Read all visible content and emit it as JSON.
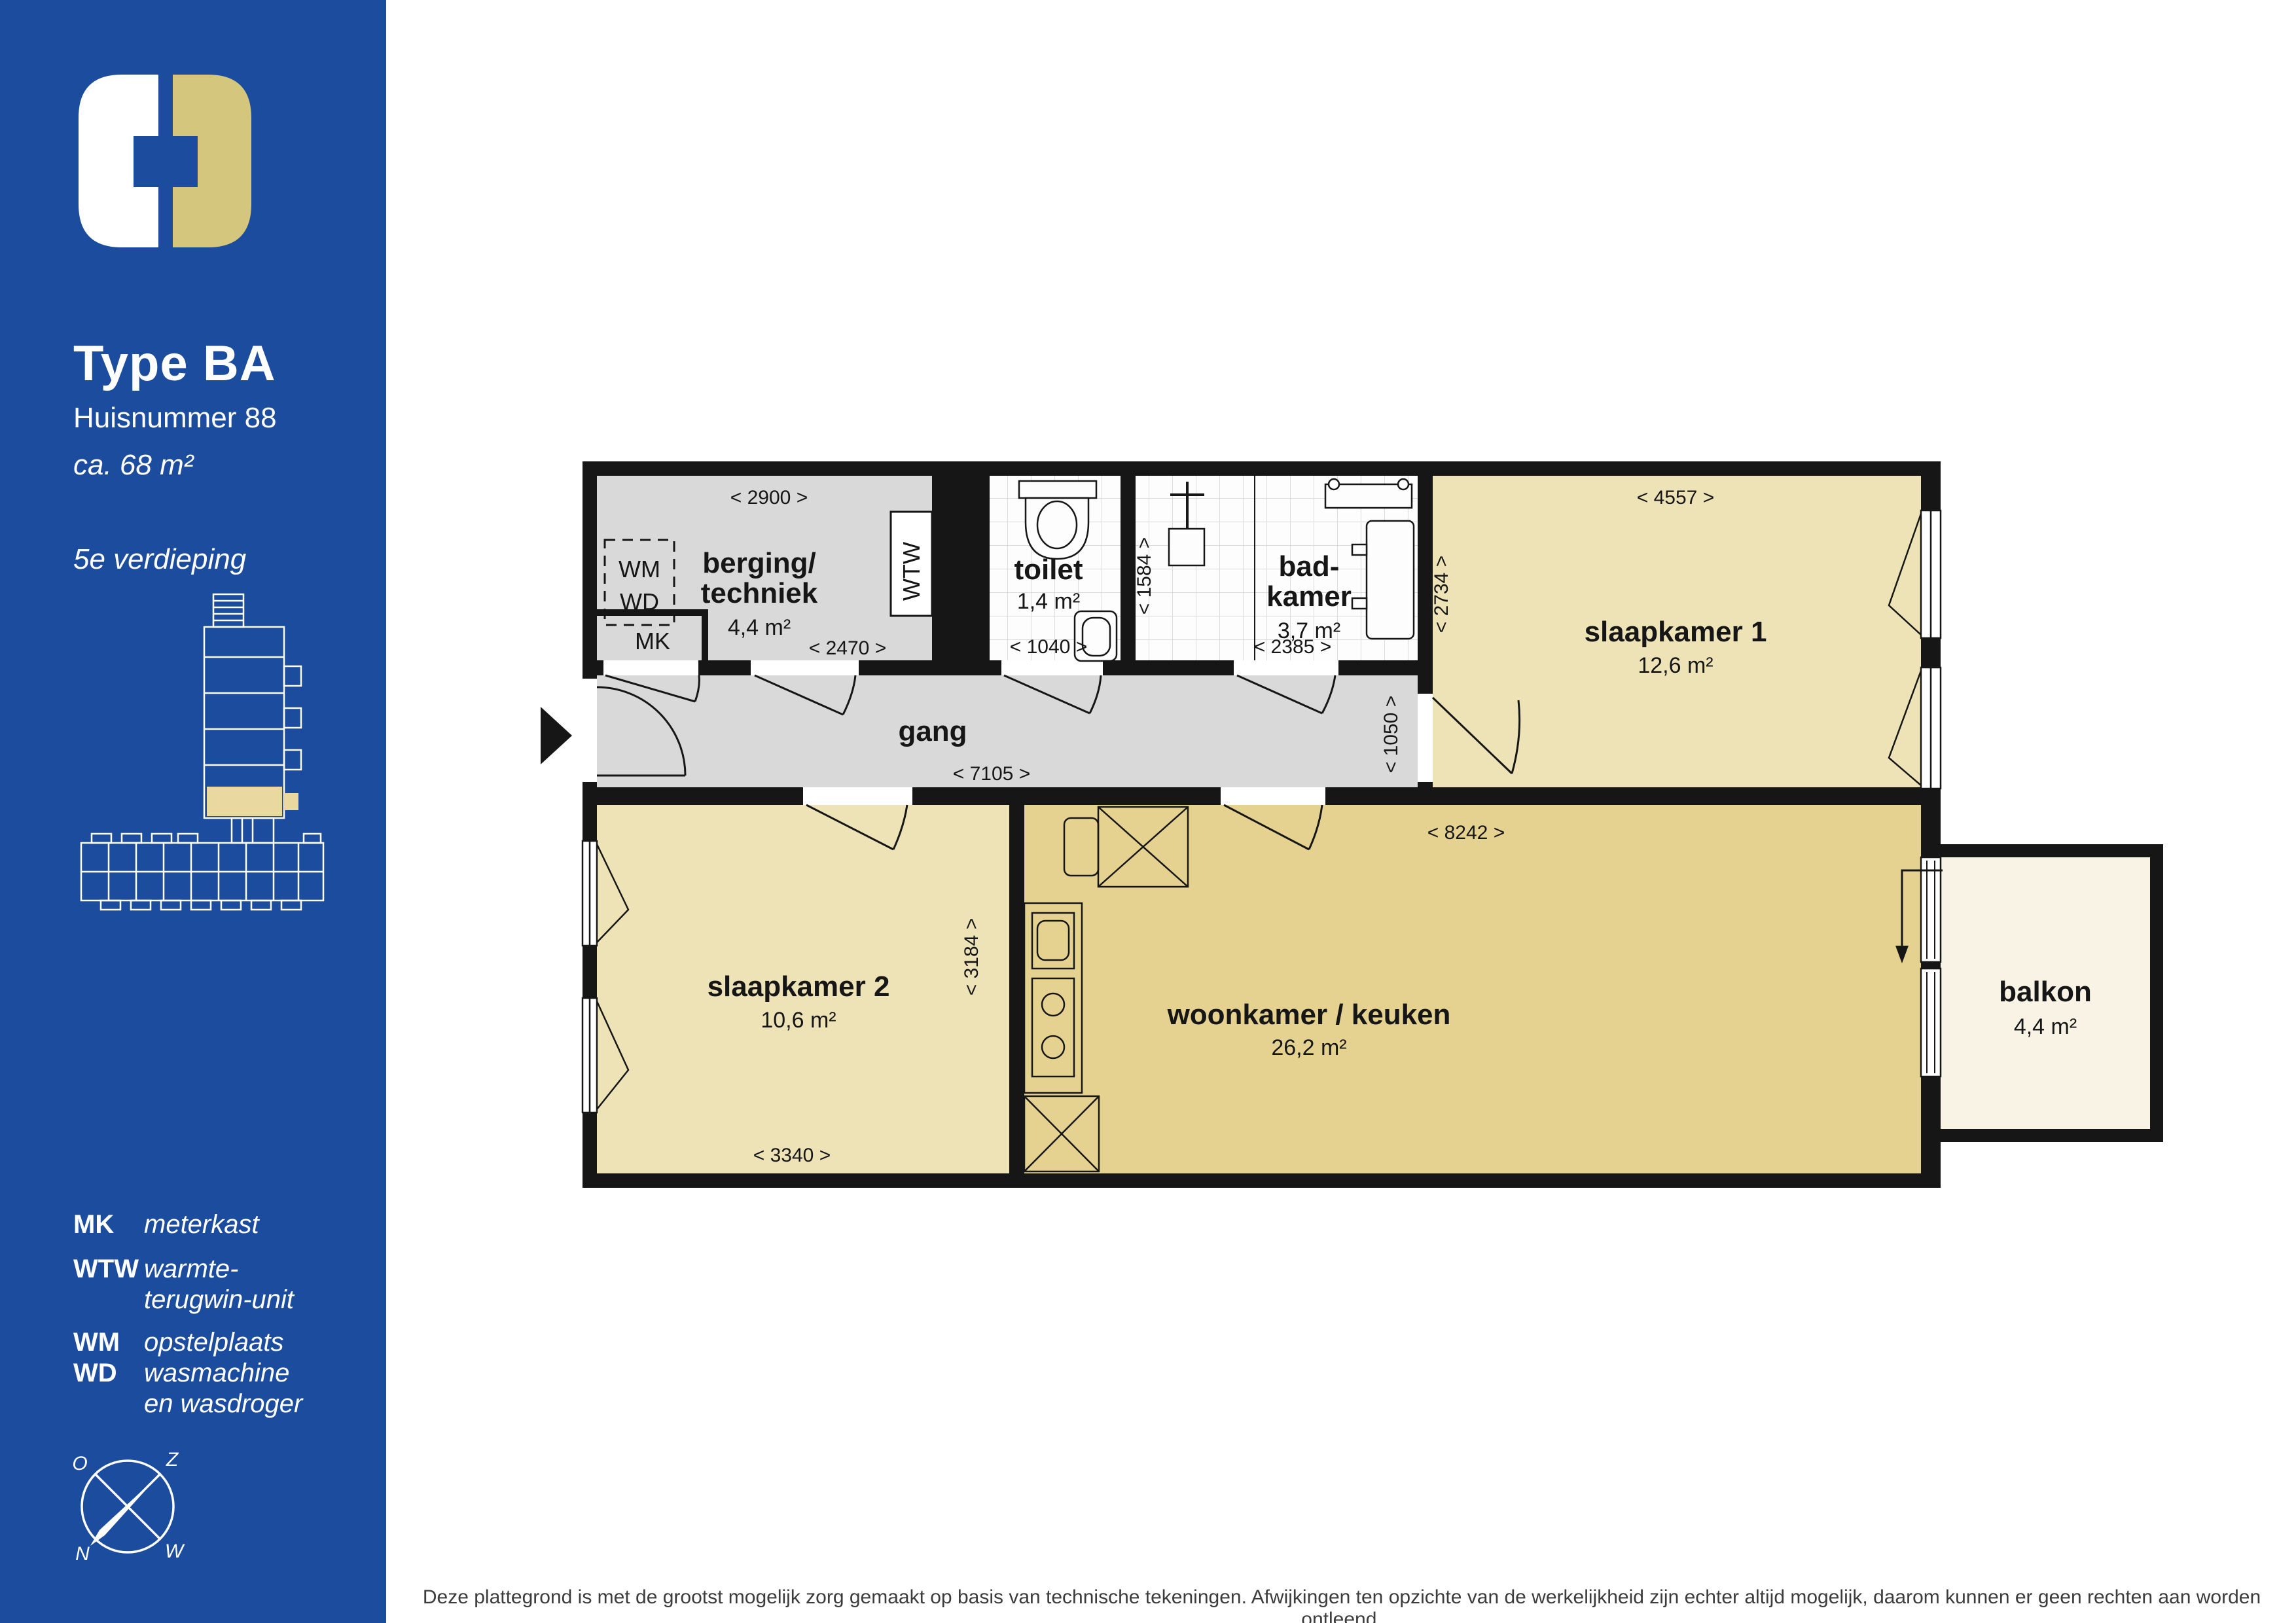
{
  "sidebar": {
    "title": "Type BA",
    "subtitle": "Huisnummer 88",
    "area": "ca. 68 m²",
    "floor": "5e verdieping",
    "legend": {
      "mk_abbr": "MK",
      "mk_label": "meterkast",
      "wtw_abbr": "WTW",
      "wtw_label_1": "warmte-",
      "wtw_label_2": "terugwin-unit",
      "wm_abbr": "WM",
      "wd_abbr": "WD",
      "wmwd_label_1": "opstelplaats",
      "wmwd_label_2": "wasmachine",
      "wmwd_label_3": "en wasdroger"
    },
    "compass": {
      "north": "N",
      "south": "Z",
      "east": "O",
      "west": "W"
    }
  },
  "plan": {
    "berging": {
      "name_1": "berging/",
      "name_2": "techniek",
      "area": "4,4 m²",
      "dim_top": "< 2900 >",
      "dim_bottom": "< 2470 >",
      "wm_label": "WM",
      "wd_label": "WD",
      "mk_label": "MK",
      "wtw_label": "WTW"
    },
    "toilet": {
      "name": "toilet",
      "area": "1,4 m²",
      "dim_bottom": "< 1040 >"
    },
    "badkamer": {
      "name_1": "bad-",
      "name_2": "kamer",
      "area": "3,7 m²",
      "dim_bottom": "< 2385 >",
      "dim_left": "< 1584 >"
    },
    "slaapkamer1": {
      "name": "slaapkamer 1",
      "area": "12,6 m²",
      "dim_top": "< 4557 >",
      "dim_left": "< 2734 >"
    },
    "gang": {
      "name": "gang",
      "dim_bottom": "< 7105 >",
      "dim_right": "< 1050 >"
    },
    "slaapkamer2": {
      "name": "slaapkamer 2",
      "area": "10,6 m²",
      "dim_bottom": "< 3340 >",
      "dim_right": "< 3184 >"
    },
    "woonkamer": {
      "name": "woonkamer / keuken",
      "area": "26,2 m²",
      "dim_top": "< 8242 >"
    },
    "balkon": {
      "name": "balkon",
      "area": "4,4 m²"
    }
  },
  "footer": {
    "disclaimer": "Deze plattegrond is met de grootst mogelijk zorg gemaakt op basis van technische tekeningen. Afwijkingen ten opzichte van de werkelijkheid zijn echter altijd mogelijk, daarom kunnen er geen rechten aan worden ontleend."
  },
  "colors": {
    "sidebar_blue": "#1c4c9e",
    "logo_gold": "#d5c67e",
    "minimap_highlight": "#e9d9a0",
    "floor_gray": "#d9d9d9",
    "floor_tan": "#eee3b6",
    "floor_gold": "#e5d290",
    "floor_cream": "#f8f3e4",
    "wall_black": "#161616"
  }
}
